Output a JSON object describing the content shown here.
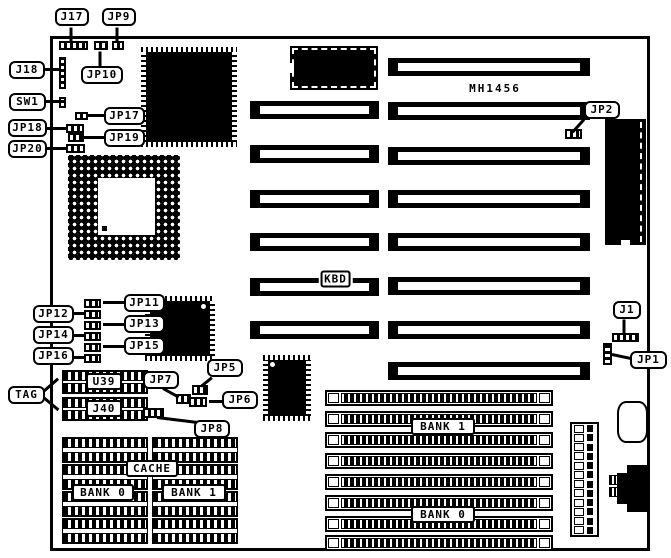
{
  "board": {
    "part_number": "MH1456"
  },
  "chips": {
    "cpu_qfp_label": "CPU",
    "cpu_pga_label": "CPU",
    "bios_label": "BIOS",
    "kbd_label": "KBD",
    "u39_label": "U39",
    "j40_label": "J40",
    "cache_label": "CACHE",
    "cache_bank0_label": "BANK 0",
    "cache_bank1_label": "BANK 1"
  },
  "memory": {
    "bank1_label": "BANK 1",
    "bank0_label": "BANK 0",
    "simm_count": 8
  },
  "slots": {
    "long_count": 8,
    "short_count": 6
  },
  "cache": {
    "rows": 4,
    "cols": 2
  },
  "power_connector": {
    "pin_count": 12
  },
  "callouts": {
    "j17": "J17",
    "jp9": "JP9",
    "jp10": "JP10",
    "j18": "J18",
    "sw1": "SW1",
    "jp17": "JP17",
    "jp18": "JP18",
    "jp19": "JP19",
    "jp20": "JP20",
    "jp2": "JP2",
    "jp11": "JP11",
    "jp12": "JP12",
    "jp13": "JP13",
    "jp14": "JP14",
    "jp15": "JP15",
    "jp16": "JP16",
    "tag": "TAG",
    "jp7": "JP7",
    "jp5": "JP5",
    "jp6": "JP6",
    "jp8": "JP8",
    "j1": "J1",
    "jp1": "JP1"
  },
  "colors": {
    "ink": "#000000",
    "paper": "#ffffff"
  }
}
